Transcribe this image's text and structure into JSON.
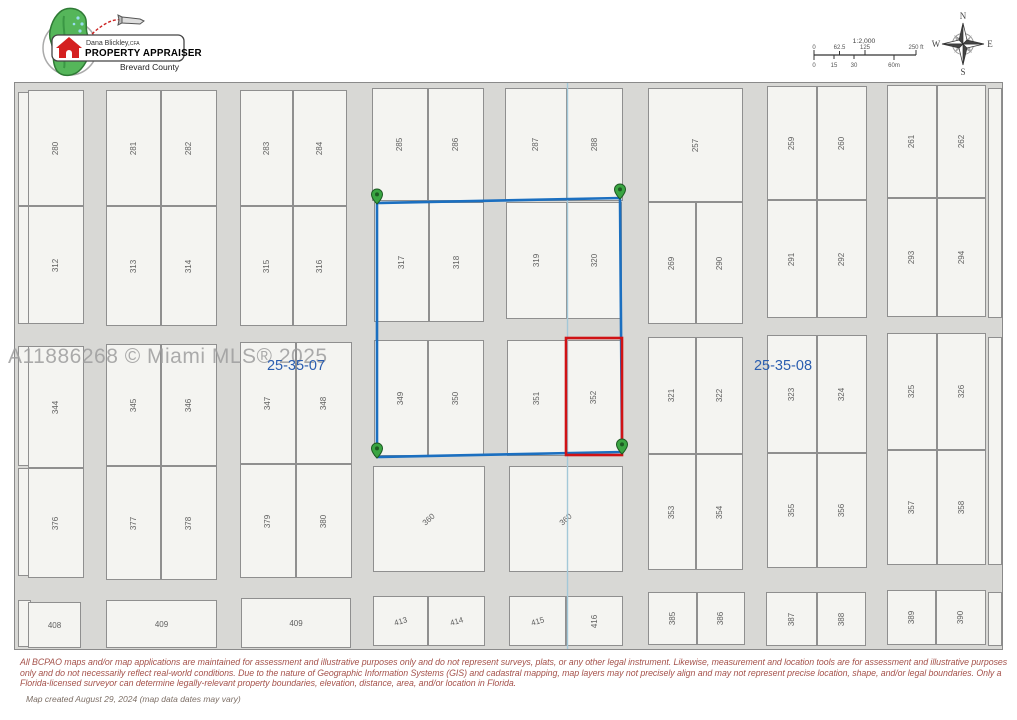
{
  "header": {
    "logo": {
      "name": "Dana Blickley,",
      "credential": "CFA",
      "title": "PROPERTY APPRAISER",
      "county": "Brevard County"
    },
    "scale": {
      "ratio": "1:2,000",
      "ft_ticks": [
        "0",
        "62.5",
        "125",
        "250 ft"
      ],
      "m_ticks": [
        "0",
        "15",
        "30",
        "60m"
      ]
    },
    "compass": {
      "n": "N",
      "e": "E",
      "s": "S",
      "w": "W"
    }
  },
  "map": {
    "watermark": "A11886268 © Miami MLS® 2025",
    "section_labels": [
      {
        "text": "25-35-07",
        "x": 296,
        "y": 366
      },
      {
        "text": "25-35-08",
        "x": 783,
        "y": 366
      }
    ],
    "colors": {
      "selection_blue": "#1b6fc0",
      "selection_red": "#d01215",
      "pin_green": "#3aa542",
      "pin_dark": "#1d5a23",
      "section_line": "#a3c8d8"
    },
    "selection": {
      "blue_polygon": [
        [
          377,
          203
        ],
        [
          620,
          198
        ],
        [
          622,
          452
        ],
        [
          377,
          457
        ]
      ],
      "red_rect": {
        "x": 566,
        "y": 338,
        "w": 56,
        "h": 117
      },
      "section_line": {
        "x": 567.5,
        "y1": 83,
        "y2": 649
      },
      "pins": [
        [
          377,
          204
        ],
        [
          620,
          199
        ],
        [
          377,
          458
        ],
        [
          622,
          454
        ]
      ]
    },
    "parcels": [
      {
        "n": "",
        "x": 18,
        "y": 92,
        "w": 13,
        "h": 114
      },
      {
        "n": "",
        "x": 18,
        "y": 206,
        "w": 13,
        "h": 118
      },
      {
        "n": "280",
        "x": 28,
        "y": 90,
        "w": 56,
        "h": 116
      },
      {
        "n": "312",
        "x": 28,
        "y": 206,
        "w": 56,
        "h": 118
      },
      {
        "n": "281",
        "x": 106,
        "y": 90,
        "w": 55,
        "h": 116
      },
      {
        "n": "282",
        "x": 161,
        "y": 90,
        "w": 56,
        "h": 116
      },
      {
        "n": "313",
        "x": 106,
        "y": 206,
        "w": 55,
        "h": 120
      },
      {
        "n": "314",
        "x": 161,
        "y": 206,
        "w": 56,
        "h": 120
      },
      {
        "n": "283",
        "x": 240,
        "y": 90,
        "w": 53,
        "h": 116
      },
      {
        "n": "284",
        "x": 293,
        "y": 90,
        "w": 54,
        "h": 116
      },
      {
        "n": "315",
        "x": 240,
        "y": 206,
        "w": 53,
        "h": 120
      },
      {
        "n": "316",
        "x": 293,
        "y": 206,
        "w": 54,
        "h": 120
      },
      {
        "n": "285",
        "x": 372,
        "y": 88,
        "w": 56,
        "h": 113
      },
      {
        "n": "286",
        "x": 428,
        "y": 88,
        "w": 56,
        "h": 113
      },
      {
        "n": "317",
        "x": 374,
        "y": 202,
        "w": 55,
        "h": 120
      },
      {
        "n": "318",
        "x": 429,
        "y": 202,
        "w": 55,
        "h": 120
      },
      {
        "n": "287",
        "x": 505,
        "y": 88,
        "w": 62,
        "h": 113
      },
      {
        "n": "288",
        "x": 567,
        "y": 88,
        "w": 56,
        "h": 113
      },
      {
        "n": "319",
        "x": 506,
        "y": 202,
        "w": 61,
        "h": 117
      },
      {
        "n": "320",
        "x": 567,
        "y": 202,
        "w": 55,
        "h": 117
      },
      {
        "n": "257",
        "x": 648,
        "y": 88,
        "w": 95,
        "h": 114
      },
      {
        "n": "269",
        "x": 648,
        "y": 202,
        "w": 48,
        "h": 122
      },
      {
        "n": "290",
        "x": 696,
        "y": 202,
        "w": 47,
        "h": 122
      },
      {
        "n": "259",
        "x": 767,
        "y": 86,
        "w": 50,
        "h": 114
      },
      {
        "n": "260",
        "x": 817,
        "y": 86,
        "w": 50,
        "h": 114
      },
      {
        "n": "291",
        "x": 767,
        "y": 200,
        "w": 50,
        "h": 118
      },
      {
        "n": "292",
        "x": 817,
        "y": 200,
        "w": 50,
        "h": 118
      },
      {
        "n": "261",
        "x": 887,
        "y": 85,
        "w": 50,
        "h": 113
      },
      {
        "n": "262",
        "x": 937,
        "y": 85,
        "w": 49,
        "h": 113
      },
      {
        "n": "293",
        "x": 887,
        "y": 198,
        "w": 50,
        "h": 119
      },
      {
        "n": "294",
        "x": 937,
        "y": 198,
        "w": 49,
        "h": 119
      },
      {
        "n": "",
        "x": 988,
        "y": 88,
        "w": 14,
        "h": 230
      },
      {
        "n": "",
        "x": 18,
        "y": 346,
        "w": 13,
        "h": 120
      },
      {
        "n": "",
        "x": 18,
        "y": 468,
        "w": 13,
        "h": 108
      },
      {
        "n": "344",
        "x": 28,
        "y": 346,
        "w": 56,
        "h": 122
      },
      {
        "n": "376",
        "x": 28,
        "y": 468,
        "w": 56,
        "h": 110
      },
      {
        "n": "345",
        "x": 106,
        "y": 344,
        "w": 55,
        "h": 122
      },
      {
        "n": "346",
        "x": 161,
        "y": 344,
        "w": 56,
        "h": 122
      },
      {
        "n": "377",
        "x": 106,
        "y": 466,
        "w": 55,
        "h": 114
      },
      {
        "n": "378",
        "x": 161,
        "y": 466,
        "w": 56,
        "h": 114
      },
      {
        "n": "347",
        "x": 240,
        "y": 342,
        "w": 56,
        "h": 122
      },
      {
        "n": "348",
        "x": 296,
        "y": 342,
        "w": 56,
        "h": 122
      },
      {
        "n": "379",
        "x": 240,
        "y": 464,
        "w": 56,
        "h": 114
      },
      {
        "n": "380",
        "x": 296,
        "y": 464,
        "w": 56,
        "h": 114
      },
      {
        "n": "349",
        "x": 374,
        "y": 340,
        "w": 54,
        "h": 116
      },
      {
        "n": "350",
        "x": 428,
        "y": 340,
        "w": 56,
        "h": 116
      },
      {
        "n": "351",
        "x": 507,
        "y": 340,
        "w": 59,
        "h": 116
      },
      {
        "n": "352",
        "x": 566,
        "y": 340,
        "w": 56,
        "h": 115
      },
      {
        "n": "360",
        "x": 373,
        "y": 466,
        "w": 112,
        "h": 106,
        "r": "d"
      },
      {
        "n": "360",
        "x": 509,
        "y": 466,
        "w": 114,
        "h": 106,
        "r": "d"
      },
      {
        "n": "321",
        "x": 648,
        "y": 337,
        "w": 48,
        "h": 117
      },
      {
        "n": "322",
        "x": 696,
        "y": 337,
        "w": 47,
        "h": 117
      },
      {
        "n": "353",
        "x": 648,
        "y": 454,
        "w": 48,
        "h": 116
      },
      {
        "n": "354",
        "x": 696,
        "y": 454,
        "w": 47,
        "h": 116
      },
      {
        "n": "323",
        "x": 767,
        "y": 335,
        "w": 50,
        "h": 118
      },
      {
        "n": "324",
        "x": 817,
        "y": 335,
        "w": 50,
        "h": 118
      },
      {
        "n": "355",
        "x": 767,
        "y": 453,
        "w": 50,
        "h": 115
      },
      {
        "n": "356",
        "x": 817,
        "y": 453,
        "w": 50,
        "h": 115
      },
      {
        "n": "325",
        "x": 887,
        "y": 333,
        "w": 50,
        "h": 117
      },
      {
        "n": "326",
        "x": 937,
        "y": 333,
        "w": 49,
        "h": 117
      },
      {
        "n": "357",
        "x": 887,
        "y": 450,
        "w": 50,
        "h": 115
      },
      {
        "n": "358",
        "x": 937,
        "y": 450,
        "w": 49,
        "h": 115
      },
      {
        "n": "",
        "x": 988,
        "y": 337,
        "w": 14,
        "h": 228
      },
      {
        "n": "",
        "x": 18,
        "y": 600,
        "w": 13,
        "h": 47
      },
      {
        "n": "408",
        "x": 28,
        "y": 602,
        "w": 53,
        "h": 46,
        "r": "h"
      },
      {
        "n": "409",
        "x": 106,
        "y": 600,
        "w": 111,
        "h": 48,
        "r": "h"
      },
      {
        "n": "409",
        "x": 241,
        "y": 598,
        "w": 110,
        "h": 50,
        "r": "h"
      },
      {
        "n": "413",
        "x": 373,
        "y": 596,
        "w": 55,
        "h": 50,
        "r": "d2"
      },
      {
        "n": "414",
        "x": 428,
        "y": 596,
        "w": 57,
        "h": 50,
        "r": "d2"
      },
      {
        "n": "415",
        "x": 509,
        "y": 596,
        "w": 57,
        "h": 50,
        "r": "d2"
      },
      {
        "n": "416",
        "x": 566,
        "y": 596,
        "w": 57,
        "h": 50
      },
      {
        "n": "385",
        "x": 648,
        "y": 592,
        "w": 49,
        "h": 53
      },
      {
        "n": "386",
        "x": 697,
        "y": 592,
        "w": 48,
        "h": 53
      },
      {
        "n": "387",
        "x": 766,
        "y": 592,
        "w": 51,
        "h": 54
      },
      {
        "n": "388",
        "x": 817,
        "y": 592,
        "w": 49,
        "h": 54
      },
      {
        "n": "389",
        "x": 887,
        "y": 590,
        "w": 49,
        "h": 55
      },
      {
        "n": "390",
        "x": 936,
        "y": 590,
        "w": 50,
        "h": 55
      },
      {
        "n": "",
        "x": 988,
        "y": 592,
        "w": 14,
        "h": 54
      }
    ]
  },
  "footer": {
    "disclaimer_lines": [
      "All BCPAO maps and/or map applications are maintained for assessment and illustrative purposes only and do not represent surveys, plats, or any other legal instrument. Likewise, measurement and location tools are for assessment and illustrative purposes",
      "only and do not necessarily reflect real-world conditions. Due to the nature of Geographic Information Systems (GIS) and cadastral mapping, map layers may not precisely align and may not represent precise location, shape, and/or legal boundaries. Only a",
      "Florida-licensed surveyor can determine legally-relevant property boundaries, elevation, distance, area, and/or location in Florida."
    ],
    "map_created": "Map created August 29, 2024 (map data dates may vary)"
  }
}
